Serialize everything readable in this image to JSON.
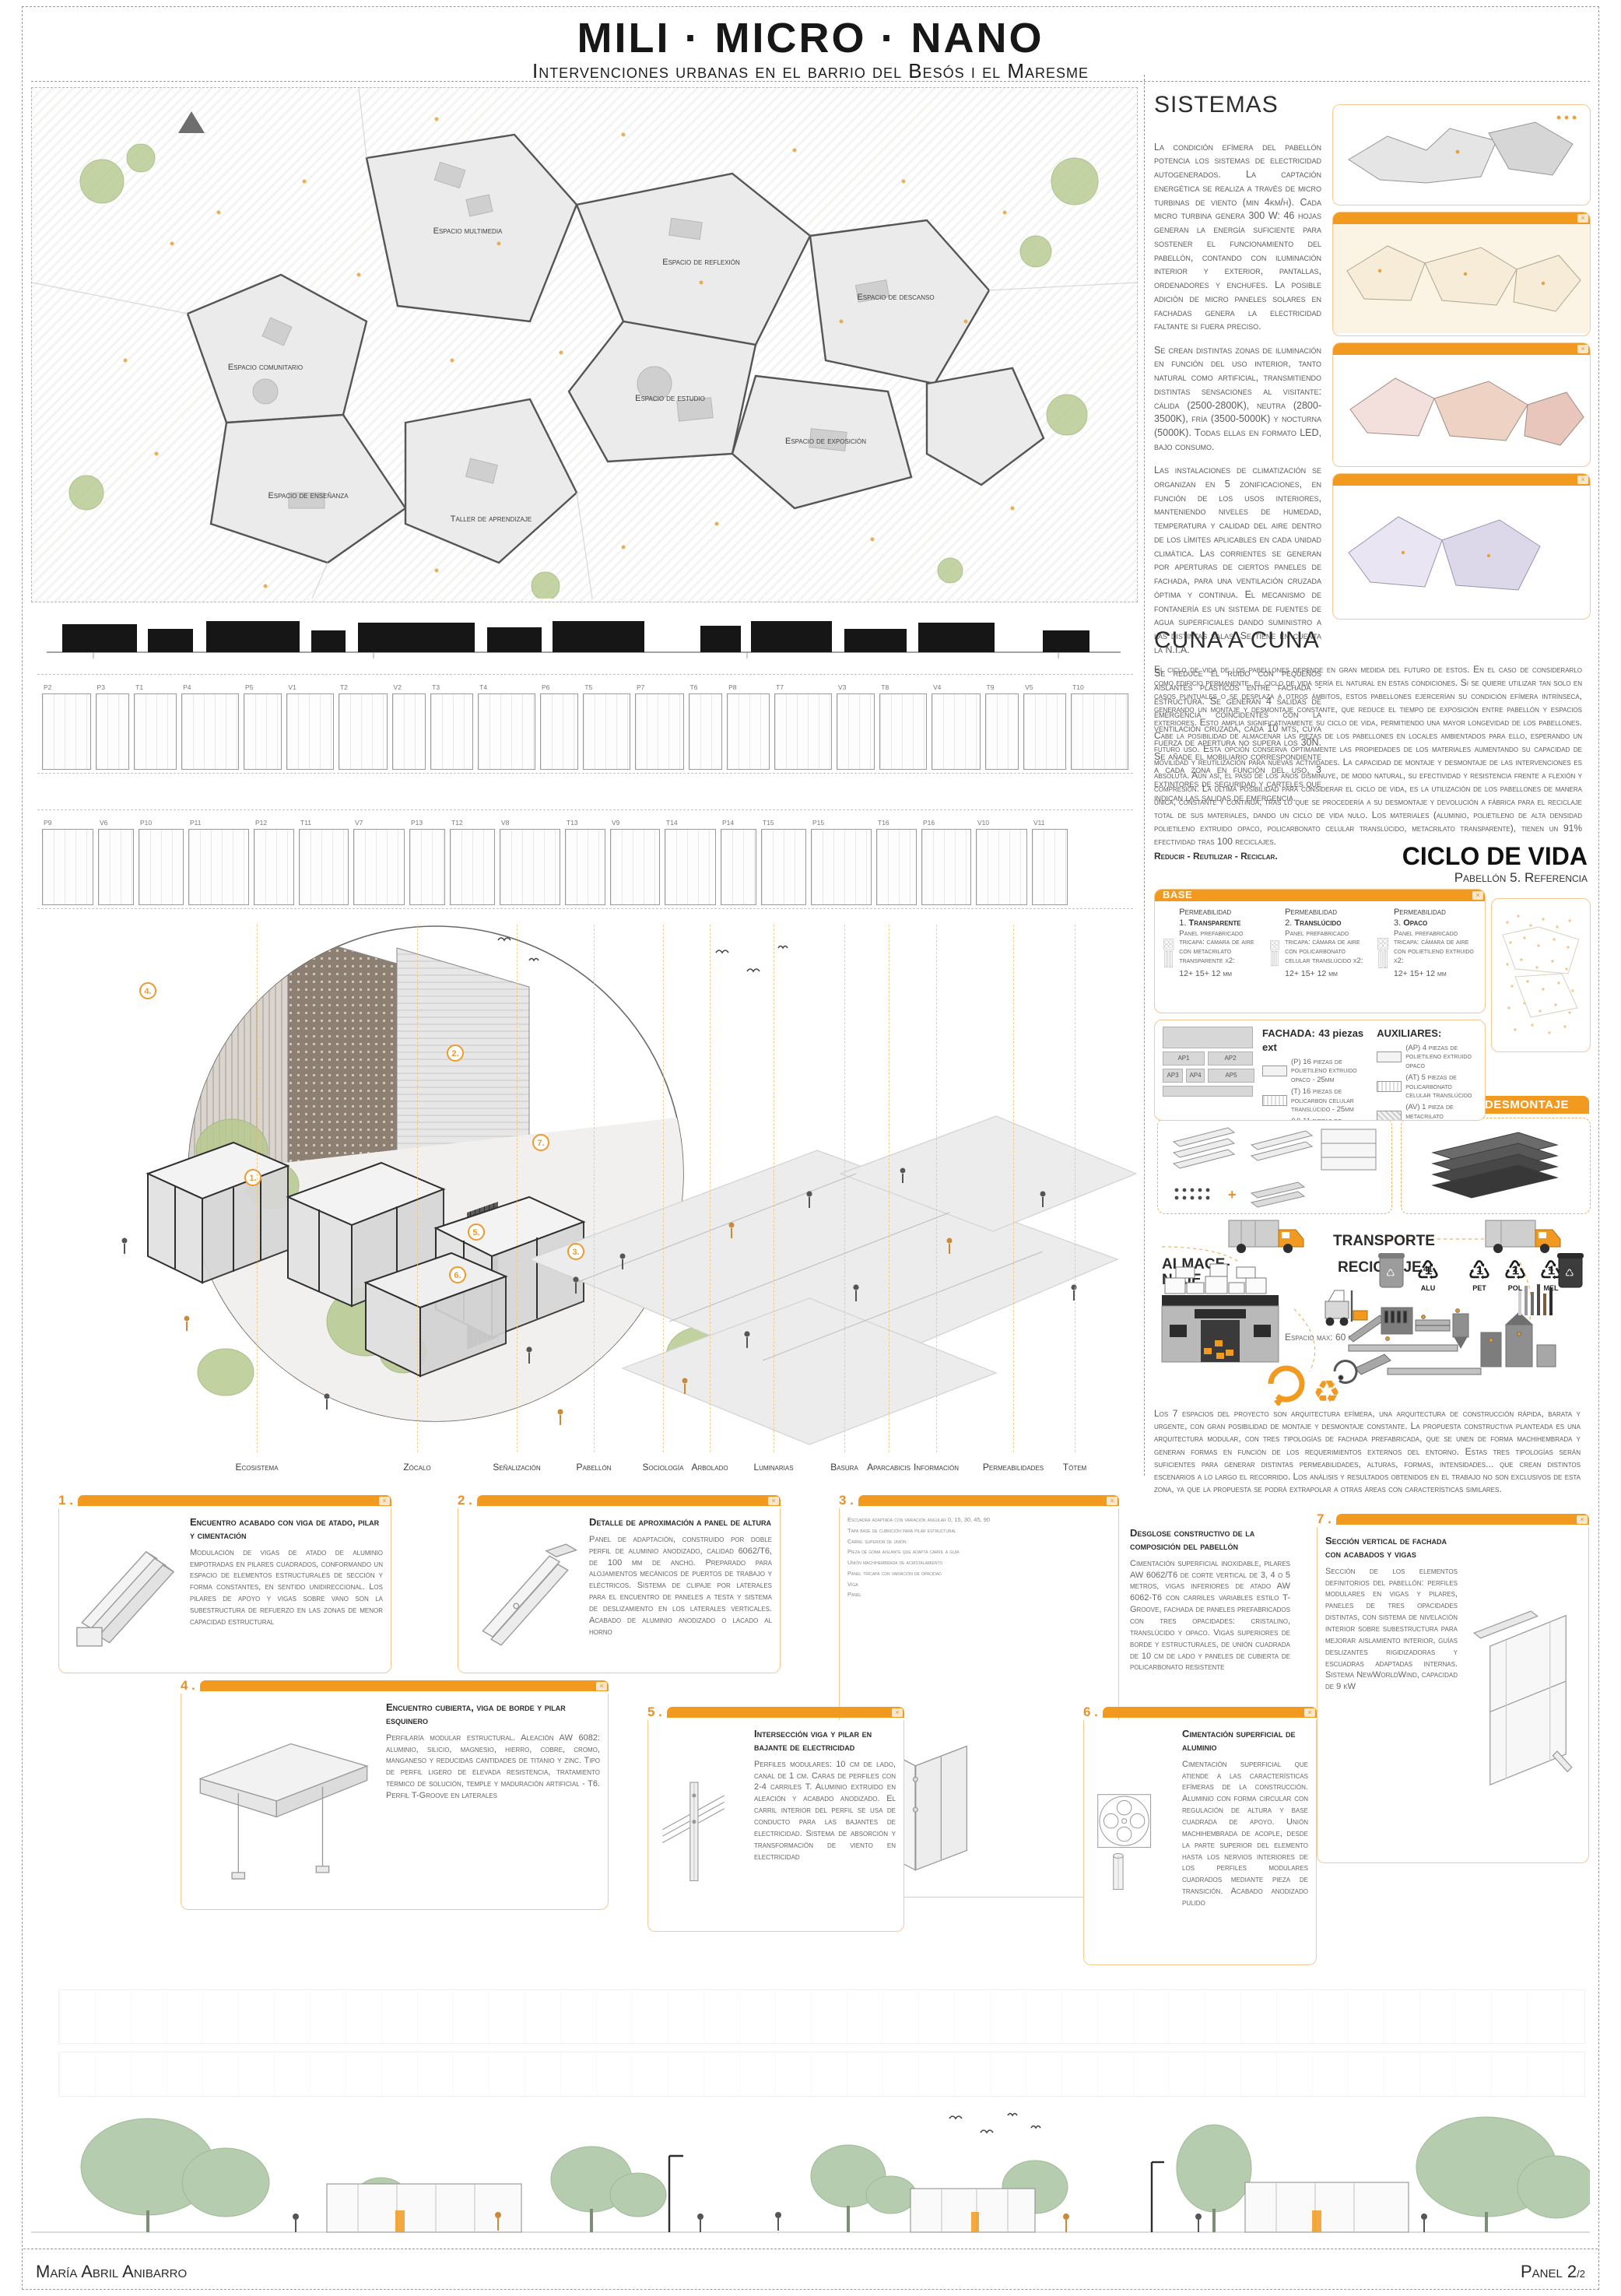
{
  "header": {
    "title": "MILI · MICRO · NANO",
    "subtitle": "Intervenciones urbanas en el barrio del Besós i el Maresme"
  },
  "site_plan": {
    "labels": [
      "Espacio multimedia",
      "Espacio de reflexión",
      "Espacio de descanso",
      "Espacio comunitario",
      "Espacio de estudio",
      "Espacio de exposición",
      "Espacio de enseñanza",
      "Taller de aprendizaje"
    ]
  },
  "strips": {
    "rows": [
      [
        "P2",
        "P3",
        "T1",
        "P4",
        "P5",
        "V1",
        "T2",
        "V2",
        "T3",
        "T4",
        "P6",
        "T5",
        "P7",
        "T6",
        "P8",
        "T7",
        "V3",
        "T8",
        "V4",
        "T9",
        "V5",
        "T10"
      ],
      [
        "P9",
        "V6",
        "P10",
        "P11",
        "P12",
        "T11",
        "V7",
        "P13",
        "T12",
        "V8",
        "T13",
        "V9",
        "T14",
        "P14",
        "T15",
        "P15",
        "T16",
        "P16",
        "V10",
        "V11"
      ]
    ]
  },
  "axon": {
    "labels": [
      "Ecosistema",
      "Zócalo",
      "Señalización",
      "Pabellón",
      "Sociología",
      "Arbolado",
      "Luminarias",
      "Basura",
      "Aparcabicis",
      "Información",
      "Permeabilidades",
      "Tótem"
    ],
    "markers": [
      "4",
      "2",
      "7",
      "1",
      "5",
      "6",
      "3"
    ]
  },
  "sistemas": {
    "heading": "SISTEMAS",
    "paragraphs": [
      "La condición efímera del pabellón potencia los sistemas de electricidad autogenerados. La captación energética se realiza a través de micro turbinas de viento (min 4km/h). Cada micro turbina genera 300 W: 46 hojas generan la energía suficiente para sostener el funcionamiento del pabellón, contando con iluminación interior y exterior, pantallas, ordenadores y enchufes. La posible adición de micro paneles solares en fachadas genera la electricidad faltante si fuera preciso.",
      "Se crean distintas zonas de iluminación en función del uso interior, tanto natural como artificial, transmitiendo distintas sensaciones al visitante: cálida (2500-2800K), neutra (2800- 3500K), fría (3500-5000K) y nocturna (5000K). Todas ellas en formato LED, bajo consumo.",
      "Las instalaciones de climatización se organizan en 5 zonificaciones, en función de los usos interiores, manteniendo niveles de humedad, temperatura y calidad del aire dentro de los límites aplicables en cada unidad climática. Las corrientes se generan por aperturas de ciertos paneles de fachada, para una ventilación cruzada óptima y continua. El mecanismo de fontanería es un sistema de fuentes de agua superficiales dando suministro a las distintas salas. Se tiene en cuenta la N.I.A.",
      "Se reduce el ruido con pequeños aislantes plásticos entre fachada - estructura. Se generan 4 salidas de emergencia coincidentes con la ventilación cruzada, cada 10 mts, cuya fuerza de apertura no supera los 30N. Se añade el mobiliario correspondiente a cada zona en función del uso, 3 extintores de seguridad y carteles que indican las salidas de emergencia."
    ]
  },
  "cuna": {
    "heading": "CUNA A CUNA",
    "paragraph": "El ciclo de vida de los pabellones depende en gran medida del futuro de estos. En el caso de considerarlo como edificio permanente, el ciclo de vida sería el natural en estas condiciones. Si se quiere utilizar tan solo en casos puntuales o se desplaza a otros ámbitos, estos pabellones ejercerían su condición efímera intrínseca, generando un montaje y desmontaje constante, que reduce el tiempo de exposición entre pabellón y espacios exteriores. Esto amplia significativamente su ciclo de vida, permitiendo una mayor longevidad de los pabellones. Cabe la posibilidad de almacenar las piezas de los pabellones en locales ambientados para ello, esperando un futuro uso. Esta opción conserva óptimamente las propiedades de los materiales aumentando su capacidad de movilidad y reutilización para nuevas actividades. La capacidad de montaje y desmontaje de las intervenciones es absoluta. Aún así, el paso de los años disminuye, de modo natural, su efectividad y resistencia frente a flexión y compresión. La última posibilidad para considerar el ciclo de vida, es la utilización de los pabellones de manera única, constante y continua, tras lo que se procedería a su desmontaje y devolución a fábrica para el reciclaje total de sus materiales, dando un ciclo de vida nulo. Los materiales (aluminio, polietileno de alta densidad polietileno extruido opaco, policarbonato celular translúcido, metacrilato transparente), tienen un 91% efectividad tras 100 reciclajes.",
    "motto": "Reducir - Reutilizar - Reciclar."
  },
  "ciclo": {
    "title": "CICLO DE VIDA",
    "subtitle": "Pabellón 5. Referencia"
  },
  "base_card": {
    "title": "BASE",
    "items": [
      {
        "label": "Permeabilidad",
        "num": "1.",
        "name": "Transparente",
        "desc": "Panel prefabricado tricapa: cámara de aire con metacrilato transparente x2:",
        "dims": "12+ 15+ 12 mm"
      },
      {
        "label": "Permeabilidad",
        "num": "2.",
        "name": "Translúcido",
        "desc": "Panel prefabricado tricapa: cámara de aire con policarbonato celular translúcido x2:",
        "dims": "12+ 15+ 12 mm"
      },
      {
        "label": "Permeabilidad",
        "num": "3.",
        "name": "Opaco",
        "desc": "Panel prefabricado tricapa: cámara de aire con polietileno extruido x2:",
        "dims": "12+ 15+ 12 mm"
      }
    ]
  },
  "fachada": {
    "title": "FACHADA:",
    "note": "43 piezas ext",
    "items": [
      {
        "text": "(P) 16 piezas de polietileno extruido opaco - 25mm"
      },
      {
        "text": "(T) 16 piezas de policarbon celular translúcido - 25mm"
      },
      {
        "text": "(V) 11 piezas de metacrilato transparente - 25mm"
      }
    ],
    "aux_title": "AUXILIARES:",
    "aux_items": [
      {
        "text": "(AP) 4 piezas de polietileno extruido opaco"
      },
      {
        "text": "(AT) 5 piezas de policarbonato celular translúcido"
      },
      {
        "text": "(AV) 1 pieza de metacrilato transparente"
      }
    ],
    "ap_labels": [
      "AP1",
      "AP2",
      "AP3",
      "AP4",
      "AP5"
    ],
    "cubierta": "CUBIERTA:",
    "cubierta_note": "polietileno de alta densidad 30 mm. Niveles:",
    "niveles": [
      "Altura 3m",
      "Altura 4m",
      "Altura 5m"
    ]
  },
  "desmontaje": {
    "title": "DESMONTAJE"
  },
  "logistics": {
    "almacenaje": "ALMACE-\nNAJE",
    "transporte": "TRANSPORTE",
    "reciclaje": "RECICLAJE",
    "espacio": "Espacio max: 60 m²",
    "symbols": [
      {
        "num": "41",
        "label": "ALU"
      },
      {
        "num": "1",
        "label": "PET"
      },
      {
        "num": "2",
        "label": "POL"
      },
      {
        "num": "4",
        "label": "MEL"
      }
    ]
  },
  "espacios_paragraph": "Los 7 espacios del proyecto son arquitectura efímera, una arquitectura de construcción rápida, barata y urgente, con gran posibilidad de montaje y desmontaje constante. La propuesta constructiva planteada es una arquitectura modular, con tres tipologías de fachada prefabricada, que se unen de forma machihembrada y generan formas en función de los requerimientos externos del entorno. Estas tres tipologías serán suficientes para generar distintas permeabilidades, alturas, formas, intensidades... que crean distintos escenarios a lo largo el recorrido. Los análisis y resultados obtenidos en el trabajo no son exclusivos de esta zona, ya que la propuesta se podrá extrapolar a otras áreas con características similares.",
  "details": [
    {
      "num": "1",
      "title": "Encuentro acabado con viga de atado, pilar y cimentación",
      "body": "Modulación de vigas de atado de aluminio empotradas en pilares cuadrados, conformando un espacio de elementos estructurales de sección y forma constantes, en sentido unidireccional. Los pilares de apoyo y vigas sobre vano son la subestructura de refuerzo en las zonas de menor capacidad estructural"
    },
    {
      "num": "2",
      "title": "Detalle de aproximación a panel de altura",
      "body": "Panel de adaptación, construido por doble perfil de aluminio anodizado, calidad 6062/T6, de 100 mm de ancho. Preparado para alojamientos mecánicos de puertos de trabajo y eléctricos. Sistema de clipaje por laterales para el encuentro de paneles a testa y sistema de deslizamiento en los laterales verticales. Acabado de aluminio anodizado o lacado al horno"
    },
    {
      "num": "3",
      "title": "Desglose constructivo de la composición del pabellón",
      "body": "Cimentación superficial inoxidable, pilares AW 6062/T6 de corte vertical de 3, 4 o 5 metros, vigas inferiores de atado AW 6062-T6 con carriles variables estilo T-Groove, fachada de paneles prefabricados con tres opacidades: cristalino, translúcido y opaco. Vigas superiores de borde y estructurales, de unión cuadrada de 10 cm de lado y paneles de cubierta de policarbonato resistente",
      "annotations": [
        "Escuadra adaptada con variación angular 0, 15, 30, 45, 90",
        "Tapa base de cubrición para pilar estructural",
        "Carril superior de unión",
        "Pieza de goma aislante que adapta carril a guía",
        "Unión machihembrada de acristalamiento",
        "Panel tricapa con variación de opacidad",
        "Viga",
        "Panel"
      ]
    },
    {
      "num": "4",
      "title": "Encuentro cubierta, viga de borde y pilar esquinero",
      "body": "Perfilaría modular estructural. Aleación AW 6082: aluminio, silicio, magnesio, hierro, cobre, cromo, manganeso y reducidas cantidades de titanio y zinc. Tipo de perfil ligero de elevada resistencia, tratamiento térmico de solución, temple y maduración artificial - T6. Perfil T-Groove en laterales"
    },
    {
      "num": "5",
      "title": "Intersección viga y pilar en bajante de electricidad",
      "body": "Perfiles modulares: 10 cm de lado, canal de 1 cm. Caras de perfiles con 2-4 carriles T. Aluminio extruido en aleación y acabado anodizado. El carril interior del perfil se usa de conducto para las bajantes de electricidad. Sistema de absorción y transformación de viento en electricidad"
    },
    {
      "num": "6",
      "title": "Cimentación superficial de aluminio",
      "body": "Cimentación superficial que atiende a las características efímeras de la construcción. Aluminio con forma circular con regulación de altura y base cuadrada de apoyo. Unión machihembrada de acople, desde la parte superior del elemento hasta los nervios interiores de los perfiles modulares cuadrados mediante pieza de transición. Acabado anodizado pulido"
    },
    {
      "num": "7",
      "title": "Sección vertical de fachada con acabados y vigas",
      "body": "Sección de los elementos definitorios del pabellón: perfiles modulares en vigas y pilares, paneles de tres opacidades distintas, con sistema de nivelación interior sobre subestructura para mejorar aislamiento interior, guías deslizantes rigidizadoras y escuadras adaptadas internas. Sistema NewWorldWind, capacidad de 9 kW"
    }
  ],
  "footer": {
    "author": "María Abril Anibarro",
    "panel": "Panel 2",
    "panel_sub": "/2"
  },
  "colors": {
    "accent": "#f29a1f",
    "accent_light": "#f6c98e",
    "ink": "#2e2e2e"
  }
}
